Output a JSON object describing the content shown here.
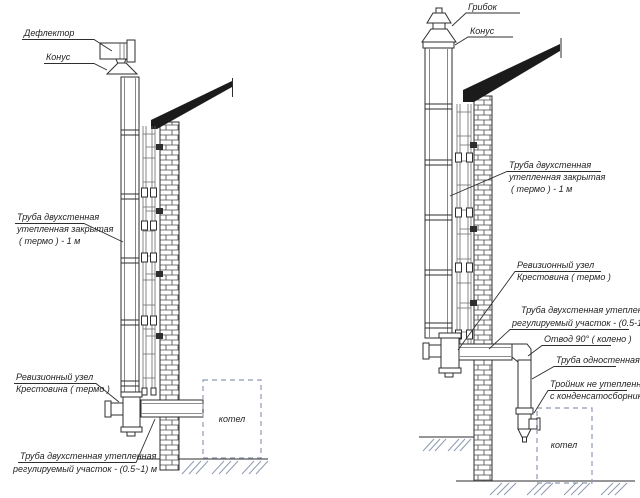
{
  "colors": {
    "line": "#2e2e2e",
    "thin": "#6a6a6a",
    "roof": "#1b1b1b",
    "accent": "#8e9ab3",
    "text": "#1f1f1f",
    "bg": "#ffffff"
  },
  "left": {
    "labels": {
      "deflector": "Дефлектор",
      "cone": "Конус",
      "pipe_closed_1": "Труба двухстенная",
      "pipe_closed_2": "утепленная закрытая",
      "pipe_closed_3": "( термо ) - 1 м",
      "revision_1": "Ревизионный узел",
      "revision_2": "Крестовина  ( термо )",
      "adjustable_1": "Труба двухстенная утепленная",
      "adjustable_2": "регулируемый участок  - (0.5~1) м",
      "boiler": "котел"
    }
  },
  "right": {
    "labels": {
      "cap": "Грибок",
      "cone": "Конус",
      "pipe_closed_1": "Труба двухстенная",
      "pipe_closed_2": "утепленная закрытая",
      "pipe_closed_3": "( термо ) - 1 м",
      "revision_1": "Ревизионный узел",
      "revision_2": "Крестовина  ( термо )",
      "adjustable_1": "Труба двухстенная утепленная",
      "adjustable_2": "регулируемый участок  - (0.5-1) м",
      "elbow": "Отвод  90° ( колено )",
      "single_wall": "Труба одностенная",
      "tee_1": "Тройник не утепленный",
      "tee_2": "с конденсатосборником",
      "boiler": "котел"
    }
  }
}
